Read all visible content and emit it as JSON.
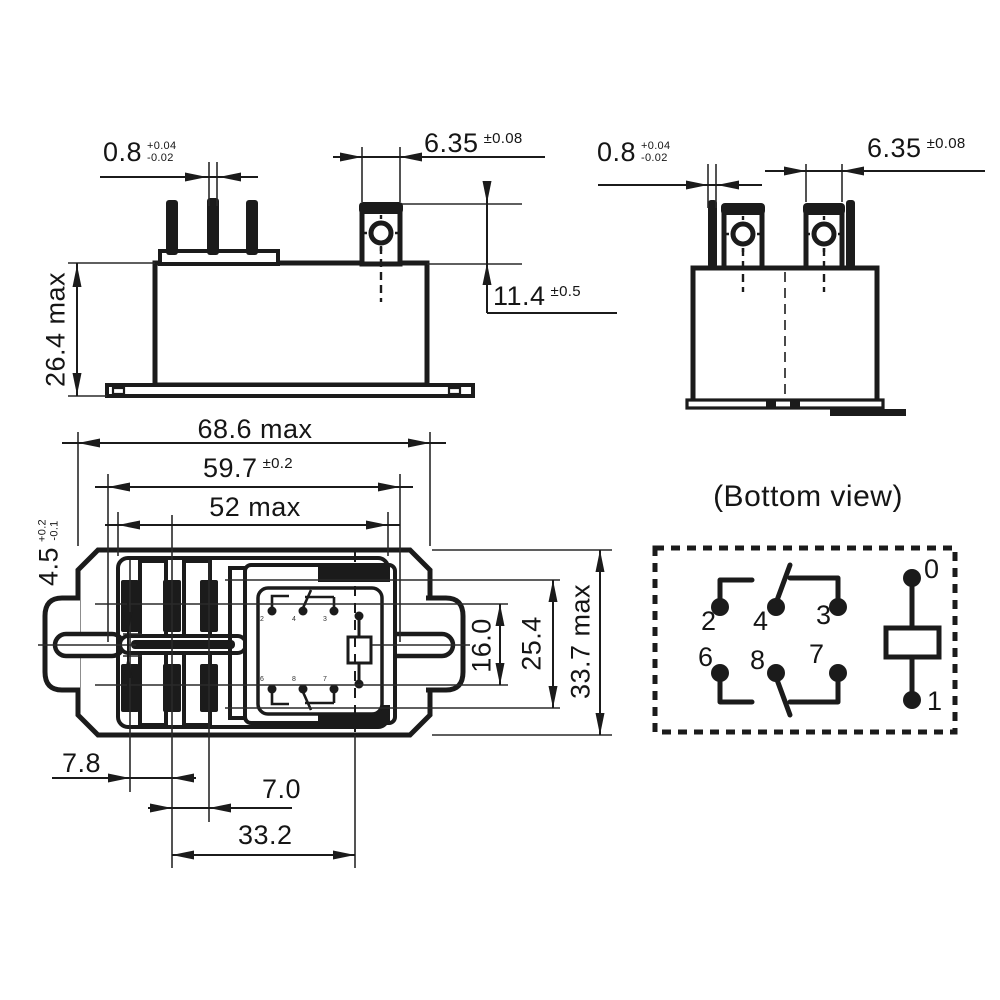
{
  "dimensions": {
    "pin_thickness": {
      "value": "0.8",
      "tol_plus": "+0.04",
      "tol_minus": "-0.02"
    },
    "tab_width": {
      "value": "6.35",
      "tol": "±0.08"
    },
    "tab_height_above_case": {
      "value": "11.4",
      "tol": "±0.5"
    },
    "case_height": {
      "value": "26.4 max"
    },
    "overall_length": {
      "value": "68.6 max"
    },
    "mounting_hole_pitch": {
      "value": "59.7",
      "tol": "±0.2"
    },
    "case_length": {
      "value": "52 max"
    },
    "mounting_slot_width": {
      "value": "4.5",
      "tol_plus": "+0.2",
      "tol_minus": "-0.1"
    },
    "contact_pin_span": {
      "value": "16.0"
    },
    "contact_row_pitch": {
      "value": "25.4"
    },
    "case_width": {
      "value": "33.7 max"
    },
    "pin_pitch_left": {
      "value": "7.8"
    },
    "pin_pitch_mid": {
      "value": "7.0"
    },
    "tab_column_offset": {
      "value": "33.2"
    }
  },
  "schematic": {
    "title": "(Bottom view)",
    "pins": {
      "coil_top": "0",
      "coil_bottom": "1",
      "top_row": [
        "2",
        "4",
        "3"
      ],
      "bottom_row": [
        "6",
        "8",
        "7"
      ]
    }
  },
  "colors": {
    "line": "#1b1b1b",
    "background": "#ffffff"
  }
}
